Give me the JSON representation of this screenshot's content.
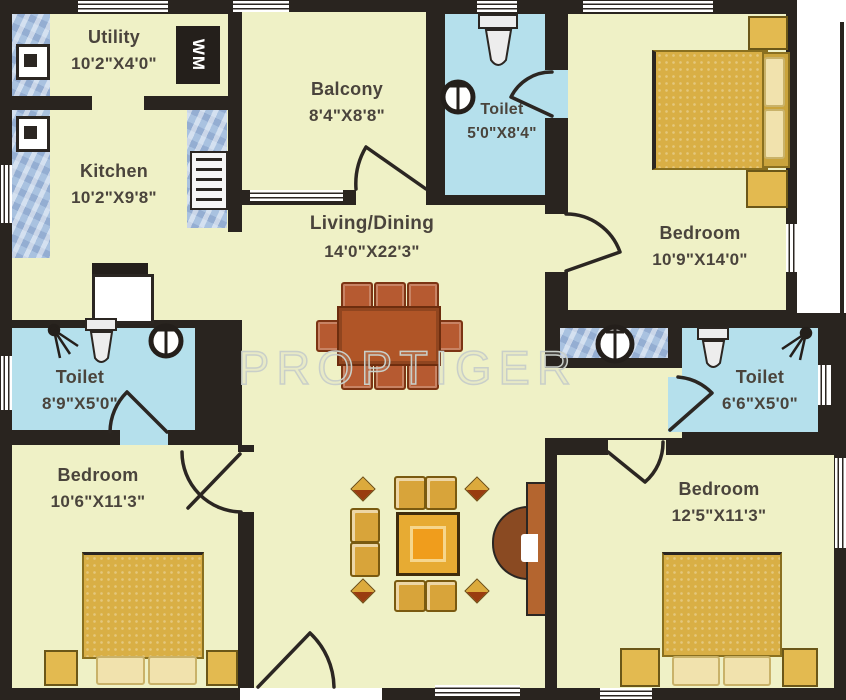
{
  "watermark": "PROPTIGER",
  "rooms": [
    {
      "id": "utility",
      "name": "Utility",
      "dims": "10'2\"X4'0\""
    },
    {
      "id": "kitchen",
      "name": "Kitchen",
      "dims": "10'2\"X9'8\""
    },
    {
      "id": "balcony",
      "name": "Balcony",
      "dims": "8'4\"X8'8\""
    },
    {
      "id": "toilet_top",
      "name": "Toilet",
      "dims": "5'0\"X8'4\""
    },
    {
      "id": "bedroom_top_right",
      "name": "Bedroom",
      "dims": "10'9\"X14'0\""
    },
    {
      "id": "living_dining",
      "name": "Living/Dining",
      "dims": "14'0\"X22'3\""
    },
    {
      "id": "toilet_left",
      "name": "Toilet",
      "dims": "8'9\"X5'0\""
    },
    {
      "id": "toilet_right",
      "name": "Toilet",
      "dims": "6'6\"X5'0\""
    },
    {
      "id": "bedroom_bottom_left",
      "name": "Bedroom",
      "dims": "10'6\"X11'3\""
    },
    {
      "id": "bedroom_bottom_right",
      "name": "Bedroom",
      "dims": "12'5\"X11'3\""
    }
  ],
  "icons": [
    "washing-machine",
    "gas-stove",
    "kitchen-sink",
    "wc",
    "washbasin",
    "shower",
    "double-bed",
    "bedside-table",
    "pillow",
    "dining-table",
    "dining-chair",
    "sofa-chair",
    "coffee-table",
    "plant",
    "main-door",
    "door-swing",
    "window"
  ],
  "washing_machine_label": "WM",
  "palette": {
    "floor": "#eff1c6",
    "toilet_floor": "#b5e0ec",
    "tile": "#a9c2e0",
    "wall": "#29241f",
    "furniture_gold": "#d9af45",
    "furniture_gold_light": "#f1e2ad",
    "dining_wood": "#b05527",
    "door_wood": "#b4652f",
    "label_text": "#4a443c",
    "watermark": "#c9cfc9",
    "fixture_white": "#ffffff"
  }
}
